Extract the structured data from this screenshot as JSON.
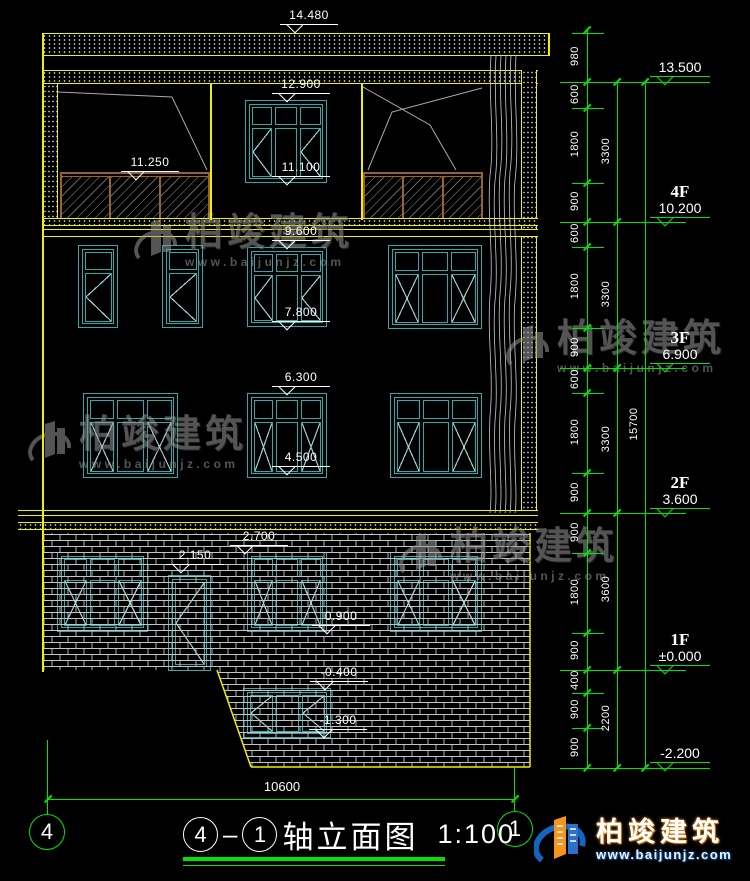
{
  "title": {
    "axis_start": "4",
    "axis_end": "1",
    "name": "轴立面图",
    "scale": "1:100"
  },
  "bottom_dim": "10600",
  "axis_bubbles": {
    "left": "4",
    "right": "1"
  },
  "floor_markers": [
    {
      "label": "",
      "elev": "13.500"
    },
    {
      "label": "4F",
      "elev": "10.200"
    },
    {
      "label": "3F",
      "elev": "6.900"
    },
    {
      "label": "2F",
      "elev": "3.600"
    },
    {
      "label": "1F",
      "elev": "±0.000"
    },
    {
      "label": "",
      "elev": "-2.200"
    }
  ],
  "drawing_markers": [
    "14.480",
    "12.900",
    "11.250",
    "11.100",
    "9.600",
    "7.800",
    "6.300",
    "4.500",
    "2.700",
    "2.150",
    "0.900",
    "-0.400",
    "-1.300"
  ],
  "dims": {
    "chain1": [
      "980",
      "600",
      "1800",
      "900",
      "600",
      "1800",
      "900",
      "600",
      "1800",
      "900",
      "900",
      "1800",
      "900",
      "400",
      "900",
      "900"
    ],
    "chain2": [
      "3300",
      "3300",
      "3300",
      "3600",
      "2200"
    ],
    "chain3": [
      "15700"
    ]
  },
  "watermark": {
    "name": "柏竣建筑",
    "url": "www.baijunjz.com"
  },
  "logo": {
    "name": "柏竣建筑",
    "url": "www.baijunjz.com"
  },
  "colors": {
    "line_yellow": "#f0f000",
    "line_green": "#00e400",
    "window_teal": "#2fa9a9",
    "railing_brown": "#9a6231",
    "logo_blue": "#1565c0",
    "logo_orange": "#f7941d"
  }
}
